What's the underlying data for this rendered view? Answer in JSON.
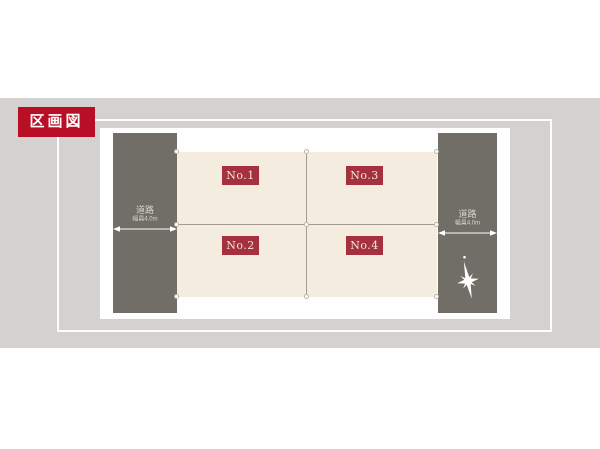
{
  "page": {
    "background": "#ffffff",
    "band_color": "#d3d2d0"
  },
  "header": {
    "title_badge": "区画図",
    "badge_color": "#b90f26"
  },
  "plan": {
    "lot_badge_color": "#a5303e",
    "lot_fill": "#f3ecdf",
    "road_fill": "#706e66",
    "divider_color": "#a29a8e",
    "lots": [
      {
        "label": "No.1",
        "position": "top-left"
      },
      {
        "label": "No.2",
        "position": "bottom-left"
      },
      {
        "label": "No.3",
        "position": "top-right"
      },
      {
        "label": "No.4",
        "position": "bottom-right"
      }
    ],
    "roads": [
      {
        "side": "left",
        "name": "道路",
        "width_label": "幅員4.0m"
      },
      {
        "side": "right",
        "name": "道路",
        "width_label": "幅員4.0m"
      }
    ],
    "compass": {
      "icon": "compass-star-icon"
    }
  }
}
